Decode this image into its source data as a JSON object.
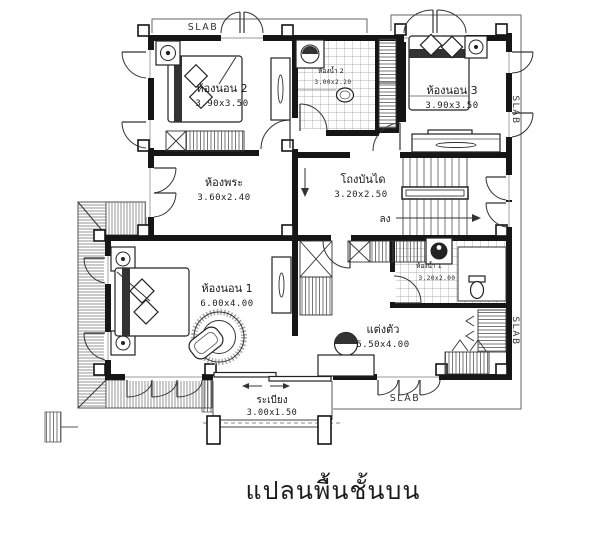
{
  "drawing": {
    "caption": "แปลนพื้นชั้นบน",
    "slab": {
      "top": "SLAB",
      "right_upper": "SLAB",
      "right_lower": "SLAB",
      "bottom": "SLAB"
    },
    "rooms": {
      "bedroom2": {
        "name": "ห้องนอน 2",
        "dims": "3.90x3.50"
      },
      "bath2": {
        "name": "ห้องน้ำ 2",
        "dims": "3.00x2.20"
      },
      "bedroom3": {
        "name": "ห้องนอน 3",
        "dims": "3.90x3.50"
      },
      "prayer_room": {
        "name": "ห้องพระ",
        "dims": "3.60x2.40"
      },
      "stair_hall": {
        "name": "โถงบันได",
        "dims": "3.20x2.50"
      },
      "bedroom1": {
        "name": "ห้องนอน 1",
        "dims": "6.00x4.00"
      },
      "bath1": {
        "name": "ห้องน้ำ 1",
        "dims": "3.20x2.00"
      },
      "dressing": {
        "name": "แต่งตัว",
        "dims": "5.50x4.00"
      },
      "balcony": {
        "name": "ระเบียง",
        "dims": "3.00x1.50"
      }
    },
    "annotations": {
      "stairs_down": "ลง"
    },
    "colors": {
      "ink": "#161616",
      "paper": "#ffffff"
    }
  }
}
